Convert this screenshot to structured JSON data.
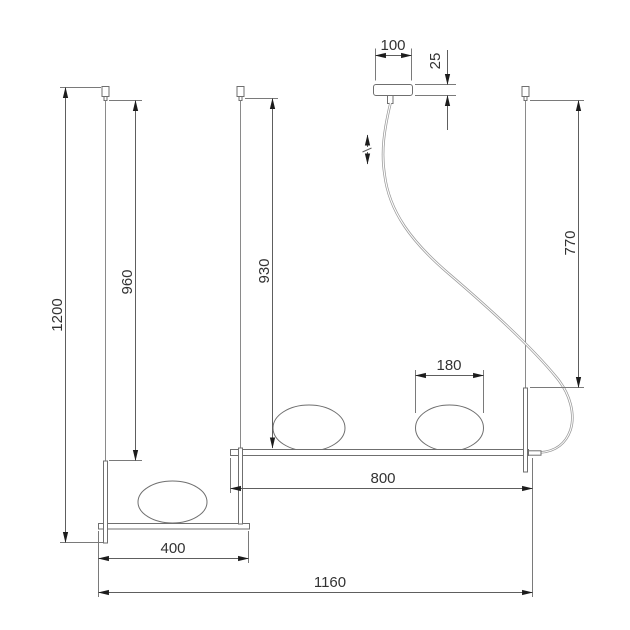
{
  "drawing": {
    "kind": "pendant-lamp-dimension-drawing",
    "units": "mm",
    "labels": {
      "canopy_width": "100",
      "canopy_height": "25",
      "overall_height": "1200",
      "left_cable_drop": "960",
      "center_cable_drop": "930",
      "right_cable_drop": "770",
      "shade_width": "180",
      "upper_bar_length": "800",
      "lower_bar_length": "400",
      "overall_width": "1160"
    }
  }
}
